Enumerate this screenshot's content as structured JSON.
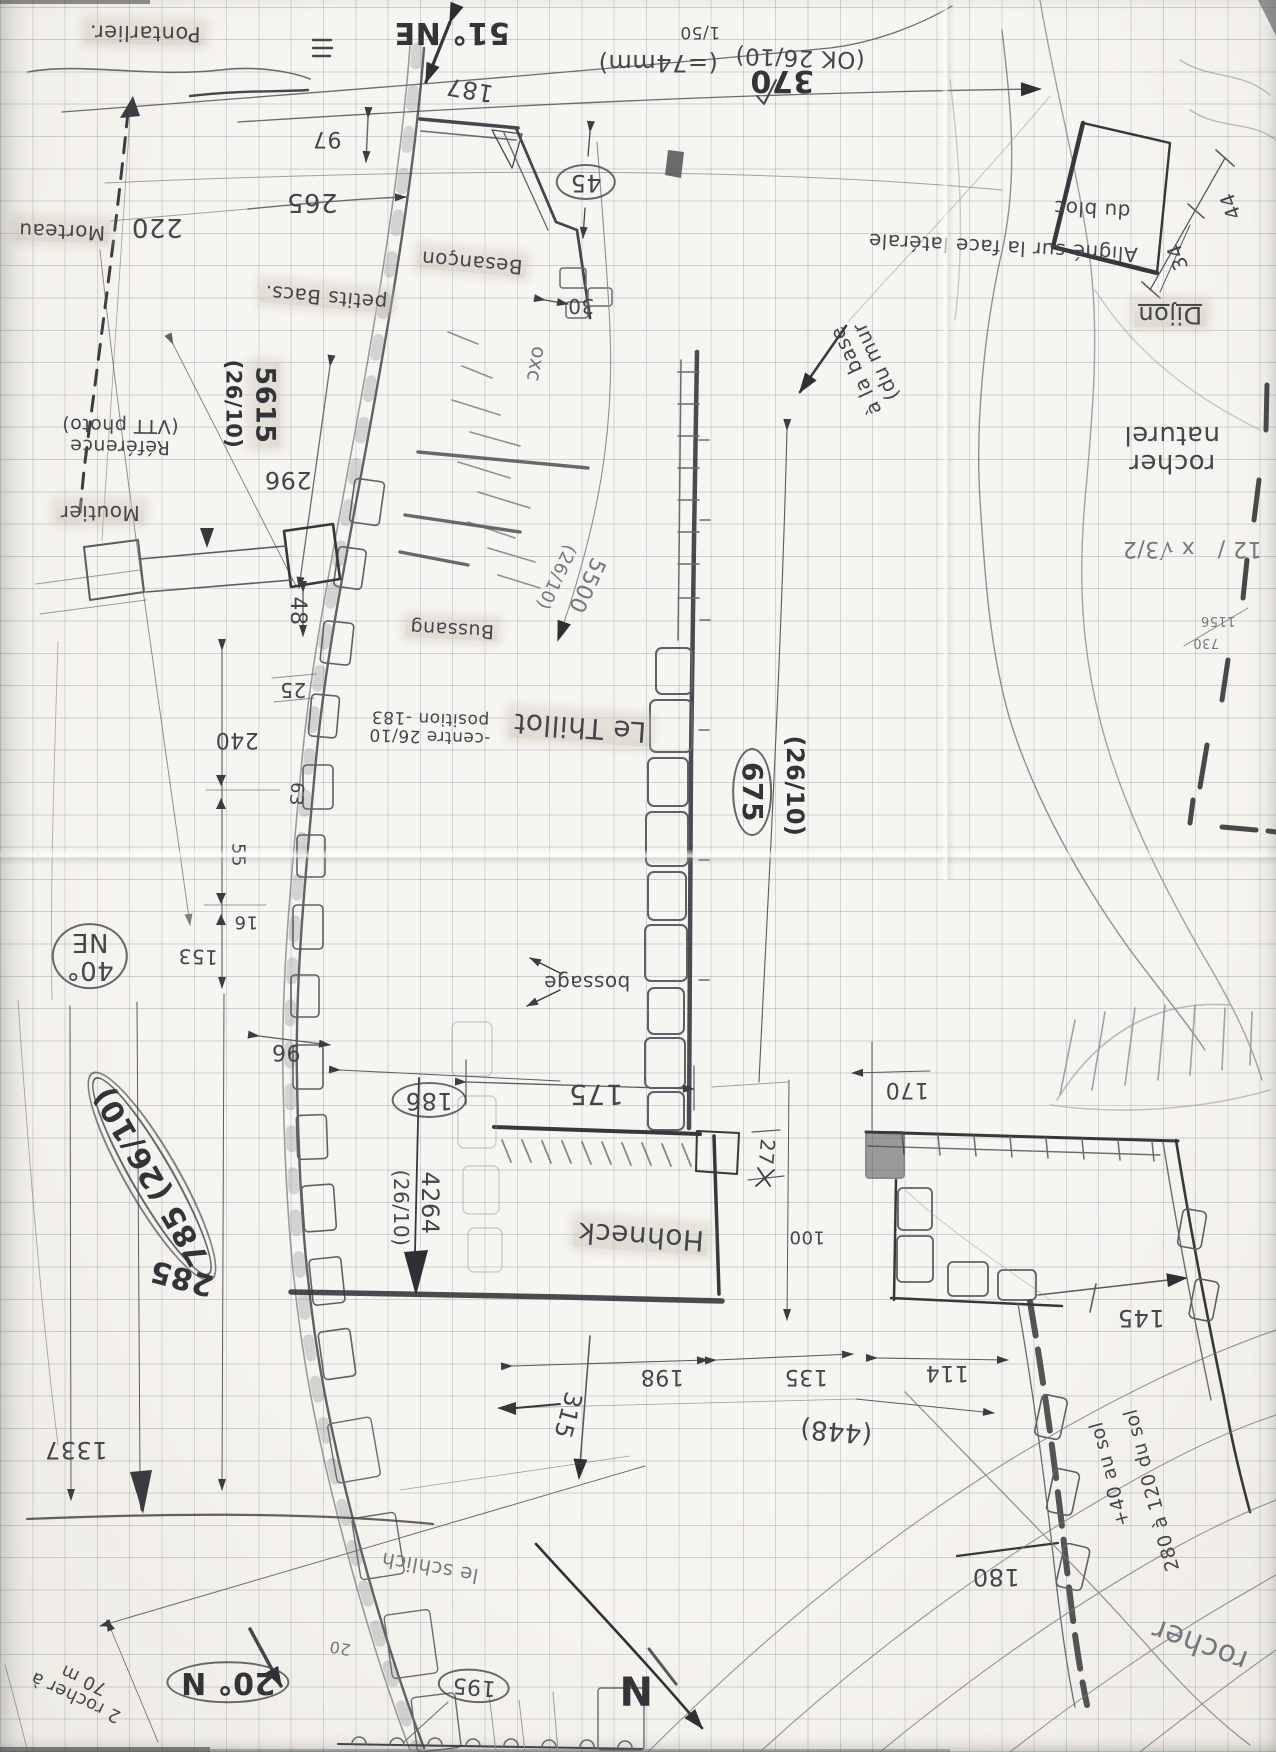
{
  "colors": {
    "paper": "#f6f4f0",
    "grid": "#7a8894",
    "pencil_dark": "#2f2f34",
    "pencil_mid": "#5a5b60",
    "pencil_light": "#8d8e94",
    "highlight": "#cac6b8"
  },
  "compass": {
    "north_label": "N"
  },
  "labels": [
    {
      "n": "pontarlier",
      "t": "Pontarlier.",
      "x": 145,
      "y": 33,
      "r": 181,
      "s": 21,
      "f": "h"
    },
    {
      "n": "bearing-51-ne",
      "t": "51° NE",
      "x": 452,
      "y": 32,
      "r": 180,
      "s": 30,
      "f": "b"
    },
    {
      "n": "dim-187",
      "t": "187",
      "x": 470,
      "y": 89,
      "r": 190,
      "s": 24
    },
    {
      "n": "dim-97",
      "t": "97",
      "x": 327,
      "y": 138,
      "r": 180,
      "s": 22
    },
    {
      "n": "dim-265",
      "t": "265",
      "x": 312,
      "y": 202,
      "r": 180,
      "s": 26
    },
    {
      "n": "dim-220",
      "t": "220",
      "x": 157,
      "y": 227,
      "r": 180,
      "s": 26
    },
    {
      "n": "morteau",
      "t": "Morteau",
      "x": 62,
      "y": 231,
      "r": 182,
      "s": 20,
      "f": "h"
    },
    {
      "n": "petits-bacs",
      "t": "petits Bacs.",
      "x": 326,
      "y": 297,
      "r": 185,
      "s": 20,
      "f": "h"
    },
    {
      "n": "scale-fraction",
      "t": "1/50",
      "x": 700,
      "y": 32,
      "r": 180,
      "s": 17
    },
    {
      "n": "scale-note",
      "t": "(=74mm)",
      "x": 658,
      "y": 62,
      "r": 180,
      "s": 24
    },
    {
      "n": "ok-2610",
      "t": "(OK 26/10)",
      "x": 800,
      "y": 57,
      "r": 182,
      "s": 23
    },
    {
      "n": "dim-370",
      "t": "370",
      "x": 782,
      "y": 80,
      "r": 180,
      "s": 30,
      "f": "b"
    },
    {
      "n": "dim-45",
      "t": "45",
      "x": 586,
      "y": 182,
      "r": 180,
      "s": 24,
      "f": "e"
    },
    {
      "n": "dim-30",
      "t": "30",
      "x": 581,
      "y": 305,
      "r": 180,
      "s": 20
    },
    {
      "n": "besancon",
      "t": "Besançon",
      "x": 472,
      "y": 262,
      "r": 185,
      "s": 20,
      "f": "h"
    },
    {
      "n": "aligne-note",
      "t": "Aligné sur la face latérale",
      "x": 1003,
      "y": 247,
      "r": 183,
      "s": 20
    },
    {
      "n": "du-bloc",
      "t": "du bloc",
      "x": 1092,
      "y": 209,
      "r": 183,
      "s": 20
    },
    {
      "n": "dijon",
      "t": "Dijon",
      "x": 1170,
      "y": 314,
      "r": 180,
      "s": 24,
      "f": "hu"
    },
    {
      "n": "dim-34",
      "t": "34",
      "x": 1178,
      "y": 257,
      "r": 250,
      "s": 20
    },
    {
      "n": "dim-44",
      "t": "44",
      "x": 1231,
      "y": 206,
      "r": 250,
      "s": 20
    },
    {
      "n": "rocher-naturel",
      "t": "rocher\nnaturel",
      "x": 1172,
      "y": 449,
      "r": 180,
      "s": 26
    },
    {
      "n": "calc-sqrt",
      "t": "12 /   x √3/2",
      "x": 1192,
      "y": 548,
      "r": 180,
      "s": 22,
      "f": "l"
    },
    {
      "n": "calc-1156",
      "t": "1156",
      "x": 1218,
      "y": 620,
      "r": 180,
      "s": 13,
      "f": "l"
    },
    {
      "n": "calc-730",
      "t": "730",
      "x": 1206,
      "y": 642,
      "r": 180,
      "s": 13,
      "f": "l"
    },
    {
      "n": "ref-5615",
      "t": "5615",
      "x": 265,
      "y": 405,
      "r": 90,
      "s": 27,
      "f": "bh"
    },
    {
      "n": "ref-5615-date",
      "t": "(26/10)",
      "x": 233,
      "y": 404,
      "r": 90,
      "s": 21,
      "f": "b"
    },
    {
      "n": "reference-photo",
      "t": "Référence\n(VTT photo)",
      "x": 120,
      "y": 436,
      "r": 181,
      "s": 19
    },
    {
      "n": "moutier",
      "t": "Moutier",
      "x": 100,
      "y": 512,
      "r": 180,
      "s": 20,
      "f": "h"
    },
    {
      "n": "dim-296",
      "t": "296",
      "x": 288,
      "y": 479,
      "r": 180,
      "s": 24
    },
    {
      "n": "dim-48",
      "t": "48",
      "x": 297,
      "y": 611,
      "r": 90,
      "s": 22
    },
    {
      "n": "oxc",
      "t": "oxc",
      "x": 536,
      "y": 364,
      "r": 100,
      "s": 20,
      "f": "l"
    },
    {
      "n": "a-la-base",
      "t": "à la base\n(du mur",
      "x": 866,
      "y": 366,
      "r": 245,
      "s": 20
    },
    {
      "n": "ref-5500",
      "t": "5500",
      "x": 586,
      "y": 585,
      "r": 115,
      "s": 22,
      "f": "l"
    },
    {
      "n": "ref-5500-date",
      "t": "(26/10)",
      "x": 556,
      "y": 577,
      "r": 115,
      "s": 18,
      "f": "l"
    },
    {
      "n": "le-thillot",
      "t": "Le Thillot",
      "x": 580,
      "y": 727,
      "r": 184,
      "s": 28,
      "f": "h"
    },
    {
      "n": "ref-675",
      "t": "675",
      "x": 752,
      "y": 792,
      "r": 90,
      "s": 28,
      "f": "be"
    },
    {
      "n": "ref-675-date",
      "t": "(26/10)",
      "x": 794,
      "y": 786,
      "r": 90,
      "s": 24,
      "f": "b"
    },
    {
      "n": "bossage",
      "t": "bossage",
      "x": 587,
      "y": 982,
      "r": 180,
      "s": 20
    },
    {
      "n": "dim-25",
      "t": "25",
      "x": 293,
      "y": 689,
      "r": 180,
      "s": 20
    },
    {
      "n": "dim-240",
      "t": "240",
      "x": 237,
      "y": 739,
      "r": 180,
      "s": 22
    },
    {
      "n": "centre-note",
      "t": "-centre 26/10\nposition -183",
      "x": 430,
      "y": 727,
      "r": 182,
      "s": 17
    },
    {
      "n": "bussang",
      "t": "Bussang",
      "x": 452,
      "y": 629,
      "r": 183,
      "s": 19,
      "f": "h"
    },
    {
      "n": "dim-63",
      "t": "63",
      "x": 296,
      "y": 794,
      "r": 95,
      "s": 18
    },
    {
      "n": "dim-55",
      "t": "55",
      "x": 238,
      "y": 855,
      "r": 90,
      "s": 18
    },
    {
      "n": "dim-16",
      "t": "16",
      "x": 246,
      "y": 922,
      "r": 180,
      "s": 18
    },
    {
      "n": "dim-153",
      "t": "153",
      "x": 198,
      "y": 956,
      "r": 182,
      "s": 20
    },
    {
      "n": "bearing-40-ne",
      "t": "40°\nNE",
      "x": 90,
      "y": 956,
      "r": 180,
      "s": 26,
      "f": "e"
    },
    {
      "n": "dim-96",
      "t": "96",
      "x": 286,
      "y": 1051,
      "r": 180,
      "s": 22
    },
    {
      "n": "dim-186",
      "t": "186",
      "x": 429,
      "y": 1100,
      "r": 180,
      "s": 24,
      "f": "e"
    },
    {
      "n": "ref-785",
      "t": "785 (26/10)",
      "x": 152,
      "y": 1176,
      "r": 240,
      "s": 30,
      "f": "beE"
    },
    {
      "n": "dim-285",
      "t": "285",
      "x": 182,
      "y": 1277,
      "r": 195,
      "s": 30,
      "f": "b"
    },
    {
      "n": "ref-4264",
      "t": "4264",
      "x": 429,
      "y": 1203,
      "r": 90,
      "s": 24
    },
    {
      "n": "ref-4264-date",
      "t": "(26/10)",
      "x": 400,
      "y": 1208,
      "r": 90,
      "s": 20
    },
    {
      "n": "dim-175",
      "t": "175",
      "x": 596,
      "y": 1094,
      "r": 180,
      "s": 28
    },
    {
      "n": "dim-27",
      "t": "27",
      "x": 766,
      "y": 1152,
      "r": 95,
      "s": 20
    },
    {
      "n": "dim-170",
      "t": "170",
      "x": 907,
      "y": 1089,
      "r": 180,
      "s": 22
    },
    {
      "n": "hohneck",
      "t": "Hohneck",
      "x": 641,
      "y": 1236,
      "r": 184,
      "s": 28,
      "f": "h"
    },
    {
      "n": "dim-100",
      "t": "100",
      "x": 807,
      "y": 1237,
      "r": 180,
      "s": 18
    },
    {
      "n": "dim-198",
      "t": "198",
      "x": 662,
      "y": 1376,
      "r": 180,
      "s": 22
    },
    {
      "n": "dim-135",
      "t": "135",
      "x": 806,
      "y": 1376,
      "r": 180,
      "s": 22
    },
    {
      "n": "dim-145",
      "t": "145",
      "x": 1141,
      "y": 1317,
      "r": 180,
      "s": 24
    },
    {
      "n": "dim-114",
      "t": "114",
      "x": 947,
      "y": 1372,
      "r": 180,
      "s": 22
    },
    {
      "n": "ref-448",
      "t": "(448)",
      "x": 836,
      "y": 1431,
      "r": 185,
      "s": 26
    },
    {
      "n": "dim-1337",
      "t": "1337",
      "x": 76,
      "y": 1449,
      "r": 180,
      "s": 24
    },
    {
      "n": "rocher-70m",
      "t": "2 rocher à\n70 m",
      "x": 80,
      "y": 1688,
      "r": 205,
      "s": 18
    },
    {
      "n": "bearing-20-n",
      "t": "20° N",
      "x": 228,
      "y": 1682,
      "r": 180,
      "s": 30,
      "f": "be"
    },
    {
      "n": "dim-315",
      "t": "315",
      "x": 567,
      "y": 1415,
      "r": 105,
      "s": 24
    },
    {
      "n": "dim-195",
      "t": "195",
      "x": 474,
      "y": 1686,
      "r": 185,
      "s": 22,
      "f": "e"
    },
    {
      "n": "north-letter",
      "t": "N",
      "x": 636,
      "y": 1689,
      "r": 180,
      "s": 40,
      "f": "b"
    },
    {
      "n": "schlich",
      "t": "le schlich",
      "x": 430,
      "y": 1567,
      "r": 190,
      "s": 20,
      "f": "l"
    },
    {
      "n": "note-280-sol",
      "t": "280 à 120 du sol",
      "x": 1152,
      "y": 1490,
      "r": 255,
      "s": 19
    },
    {
      "n": "note-40-sol",
      "t": "+40 au sol",
      "x": 1110,
      "y": 1474,
      "r": 255,
      "s": 19
    },
    {
      "n": "dim-180",
      "t": "180",
      "x": 996,
      "y": 1576,
      "r": 180,
      "s": 24
    },
    {
      "n": "rocher-cursive",
      "t": "rocher",
      "x": 1200,
      "y": 1644,
      "r": 200,
      "s": 30,
      "f": "l"
    },
    {
      "n": "dim-20-small",
      "t": "20",
      "x": 340,
      "y": 1648,
      "r": 190,
      "s": 16,
      "f": "l"
    }
  ]
}
